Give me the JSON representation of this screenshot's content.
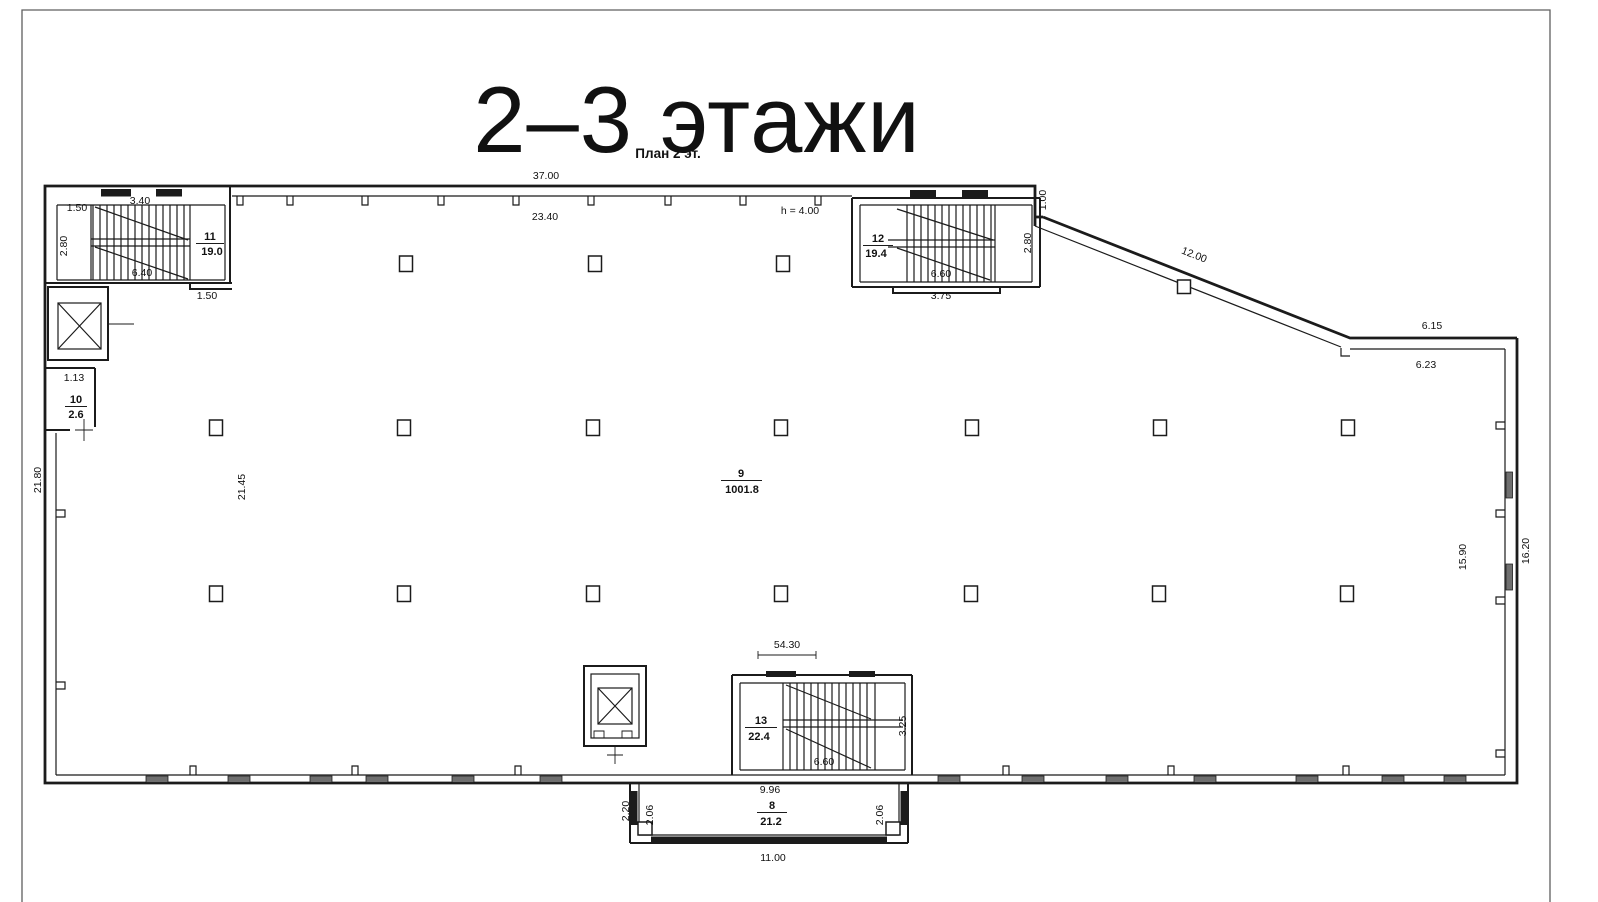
{
  "title": "2–3 этажи",
  "plan_caption": "План 2 эт.",
  "colors": {
    "accent": "#F4764A",
    "ink": "#1b1b1b",
    "window_fill": "#6f6f6f"
  },
  "dims": {
    "top_width": "37.00",
    "hall_width": "23.40",
    "height_note": "h = 4.00",
    "step": "1.00",
    "diagonal": "12.00",
    "ne_outer": "6.15",
    "ne_inner": "6.23",
    "left_outer": "21.80",
    "left_inner": "21.45",
    "right_inner": "15.90",
    "right_outer": "16.20",
    "total_width": "54.30",
    "s11_top": "3.40",
    "s11_run": "6.40",
    "s11_w": "1.50",
    "s11_h": "2.80",
    "s11_below": "1.50",
    "s12_run": "6.60",
    "s12_w": "3.75",
    "s12_h": "2.80",
    "s13_run": "6.60",
    "s13_h": "3.25",
    "s13_top": "9.96",
    "r10_w": "1.13",
    "p_out": "2.20",
    "p_in_l": "2.06",
    "p_in_r": "2.06",
    "p_w": "11.00"
  },
  "rooms": {
    "r8": {
      "n": "8",
      "a": "21.2"
    },
    "r9": {
      "n": "9",
      "a": "1001.8"
    },
    "r10": {
      "n": "10",
      "a": "2.6"
    },
    "r11": {
      "n": "11",
      "a": "19.0"
    },
    "r12": {
      "n": "12",
      "a": "19.4"
    },
    "r13": {
      "n": "13",
      "a": "22.4"
    }
  }
}
